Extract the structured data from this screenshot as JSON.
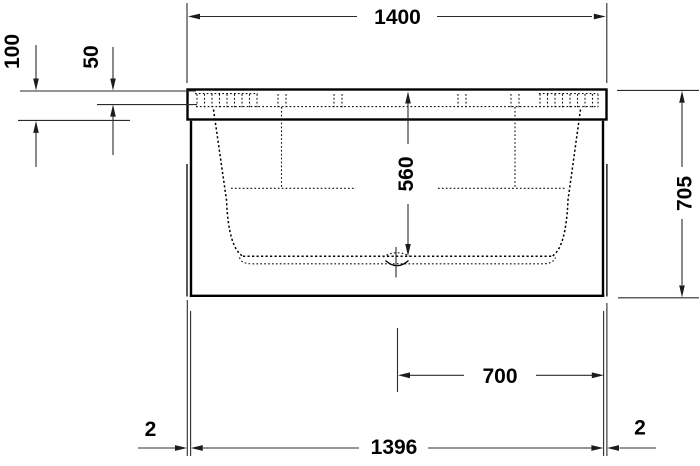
{
  "drawing": {
    "dimensions": {
      "overall_width": "1400",
      "rim_height_outer": "100",
      "rim_height_inner": "50",
      "inner_depth": "560",
      "overall_height": "705",
      "center_to_edge": "700",
      "base_width": "1396",
      "edge_gap_left": "2",
      "edge_gap_right": "2"
    }
  }
}
